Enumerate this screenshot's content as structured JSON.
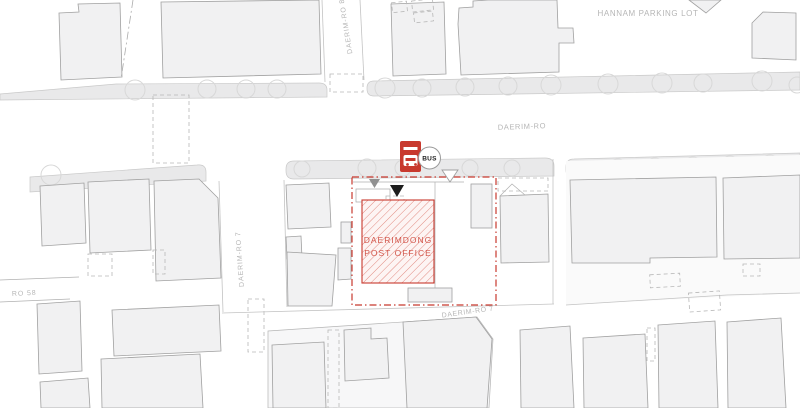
{
  "map": {
    "kind": "architectural-site-plan",
    "labels": {
      "hannam_parking_lot": "HANNAM PARKING LOT",
      "daerim_ro": "DAERIM-RO",
      "daerim_ro_7_bottom": "DAERIM-RO 7",
      "daerim_ro_7_left": "DAERIM-RO 7",
      "daerim_ro_8_top": "DAERIM-RO 8",
      "ro_58": "RO 58"
    },
    "site": {
      "name_line1": "DAERIMDONG",
      "name_line2": "POST OFFICE"
    },
    "bus_stop": {
      "label": "BUS"
    },
    "colors": {
      "accent_red": "#c8392e",
      "hatch_line_red": "#e28b81",
      "hatch_bg": "#fdf4f3",
      "post_office_text_red": "#d2564b",
      "building_fill": "#f1f1f2",
      "building_stroke": "#a0a0a0",
      "sidewalk_fill": "#e9e9ea",
      "label_gray": "#b6b6b6"
    }
  }
}
